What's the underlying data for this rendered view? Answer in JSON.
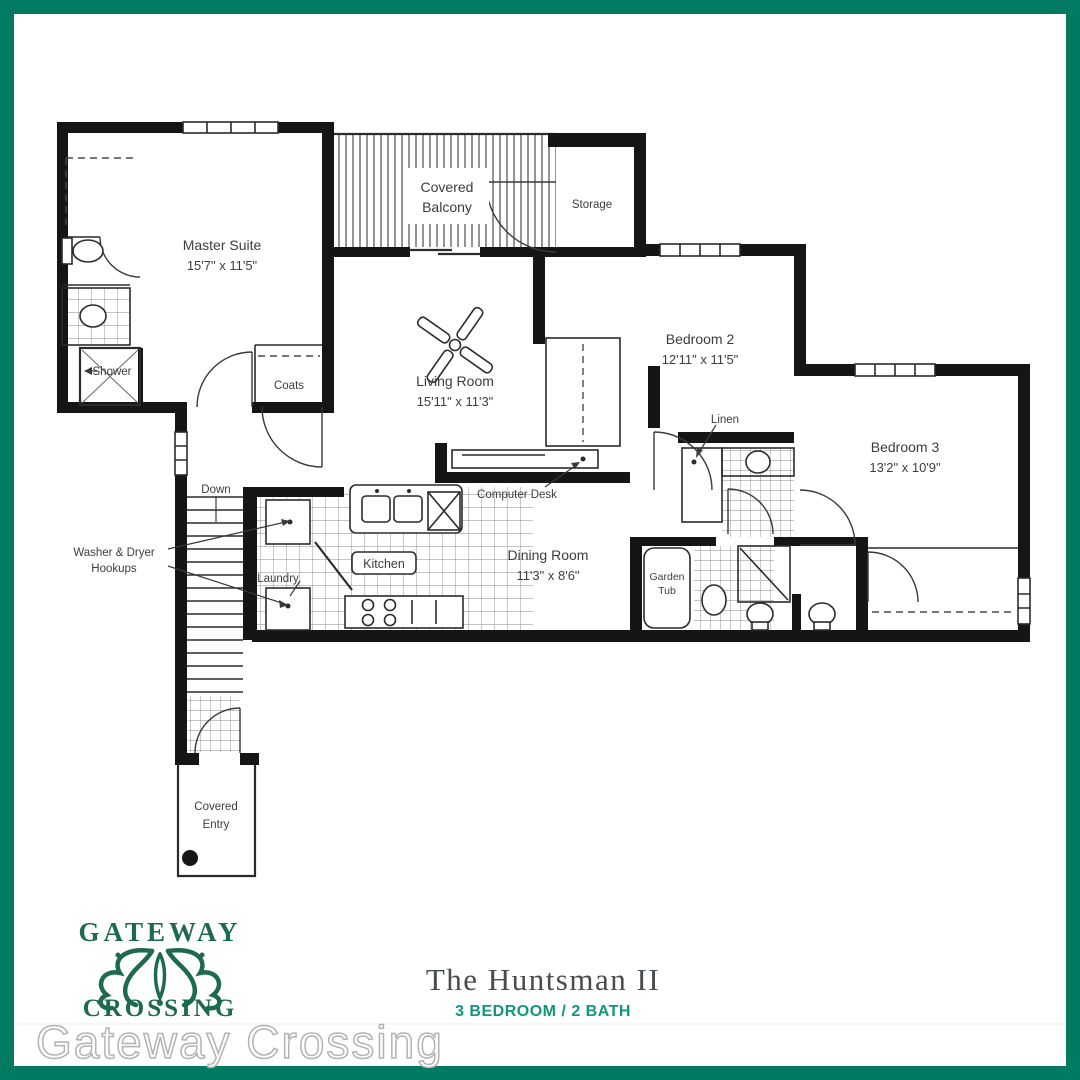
{
  "frame": {
    "border_color": "#007a60"
  },
  "floorplan": {
    "rooms": {
      "master_suite": {
        "name": "Master Suite",
        "dims": "15'7\" x 11'5\""
      },
      "living_room": {
        "name": "Living Room",
        "dims": "15'11\" x 11'3\""
      },
      "bedroom2": {
        "name": "Bedroom 2",
        "dims": "12'11\" x 11'5\""
      },
      "bedroom3": {
        "name": "Bedroom 3",
        "dims": "13'2\" x 10'9\""
      },
      "dining_room": {
        "name": "Dining Room",
        "dims": "11'3\" x 8'6\""
      },
      "covered_balcony": {
        "line1": "Covered",
        "line2": "Balcony"
      },
      "storage": {
        "name": "Storage"
      },
      "coats": {
        "name": "Coats"
      },
      "shower": {
        "name": "Shower"
      },
      "linen": {
        "name": "Linen"
      },
      "computer_desk": {
        "name": "Computer Desk"
      },
      "kitchen": {
        "name": "Kitchen"
      },
      "laundry": {
        "name": "Laundry"
      },
      "garden_tub": {
        "line1": "Garden",
        "line2": "Tub"
      },
      "covered_entry": {
        "line1": "Covered",
        "line2": "Entry"
      },
      "down": {
        "name": "Down"
      },
      "washer_dryer": {
        "line1": "Washer & Dryer",
        "line2": "Hookups"
      }
    }
  },
  "footer": {
    "logo": {
      "top": "GATEWAY",
      "bottom": "CROSSING",
      "color": "#1d6a4e"
    },
    "plan_title": "The Huntsman II",
    "plan_subtitle": "3 BEDROOM / 2 BATH",
    "subtitle_color": "#11967b",
    "watermark": "Gateway Crossing"
  }
}
